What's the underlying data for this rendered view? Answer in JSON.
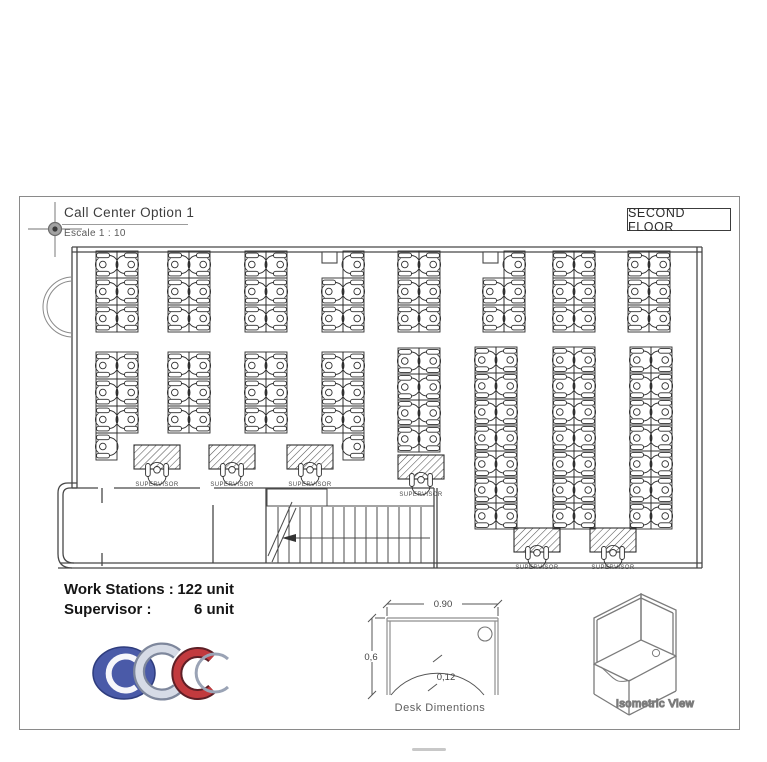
{
  "sheet": {
    "title": "Call Center Option 1",
    "scale": "Escale 1 : 10",
    "floor_tag": "SECOND FLOOR"
  },
  "stats": {
    "rows": [
      {
        "label": "Work Stations :",
        "value": "122 unit"
      },
      {
        "label": "Supervisor :",
        "value": "6 unit"
      }
    ],
    "workstation_count": 122,
    "supervisor_count": 6
  },
  "floorplan": {
    "supervisor_label": "SUPERVISOR",
    "clusters": [
      {
        "x": 96,
        "y": 251,
        "rows": 3,
        "rowH": 27,
        "skip": []
      },
      {
        "x": 168,
        "y": 251,
        "rows": 3,
        "rowH": 27,
        "skip": []
      },
      {
        "x": 245,
        "y": 251,
        "rows": 3,
        "rowH": 27,
        "skip": []
      },
      {
        "x": 322,
        "y": 251,
        "rows": 3,
        "rowH": 27,
        "skip": [
          "0L"
        ]
      },
      {
        "x": 398,
        "y": 251,
        "rows": 3,
        "rowH": 27,
        "skip": []
      },
      {
        "x": 483,
        "y": 251,
        "rows": 3,
        "rowH": 27,
        "skip": [
          "0L"
        ]
      },
      {
        "x": 553,
        "y": 251,
        "rows": 3,
        "rowH": 27,
        "skip": []
      },
      {
        "x": 628,
        "y": 251,
        "rows": 3,
        "rowH": 27,
        "skip": []
      },
      {
        "x": 96,
        "y": 352,
        "rows": 4,
        "rowH": 27,
        "skip": [
          "3R"
        ]
      },
      {
        "x": 168,
        "y": 352,
        "rows": 3,
        "rowH": 27,
        "skip": []
      },
      {
        "x": 245,
        "y": 352,
        "rows": 3,
        "rowH": 27,
        "skip": []
      },
      {
        "x": 322,
        "y": 352,
        "rows": 4,
        "rowH": 27,
        "skip": [
          "3L"
        ]
      },
      {
        "x": 398,
        "y": 348,
        "rows": 4,
        "rowH": 26,
        "skip": []
      },
      {
        "x": 475,
        "y": 347,
        "rows": 7,
        "rowH": 26,
        "skip": []
      },
      {
        "x": 553,
        "y": 347,
        "rows": 7,
        "rowH": 26,
        "skip": []
      },
      {
        "x": 630,
        "y": 347,
        "rows": 7,
        "rowH": 26,
        "skip": []
      }
    ],
    "supervisors": [
      {
        "cx": 157,
        "y": 445
      },
      {
        "cx": 232,
        "y": 445
      },
      {
        "cx": 310,
        "y": 445
      },
      {
        "cx": 421,
        "y": 455
      },
      {
        "cx": 537,
        "y": 528
      },
      {
        "cx": 613,
        "y": 528
      }
    ]
  },
  "desk_dimensions": {
    "caption": "Desk Dimentions",
    "width": "0.90",
    "height": "0,6",
    "depth": "0,12"
  },
  "isometric": {
    "caption": "Isometric View"
  },
  "logo": {
    "text": "CDC",
    "blue": "#4a5aa8",
    "silver": "#c9cfdc",
    "red": "#b23338"
  }
}
